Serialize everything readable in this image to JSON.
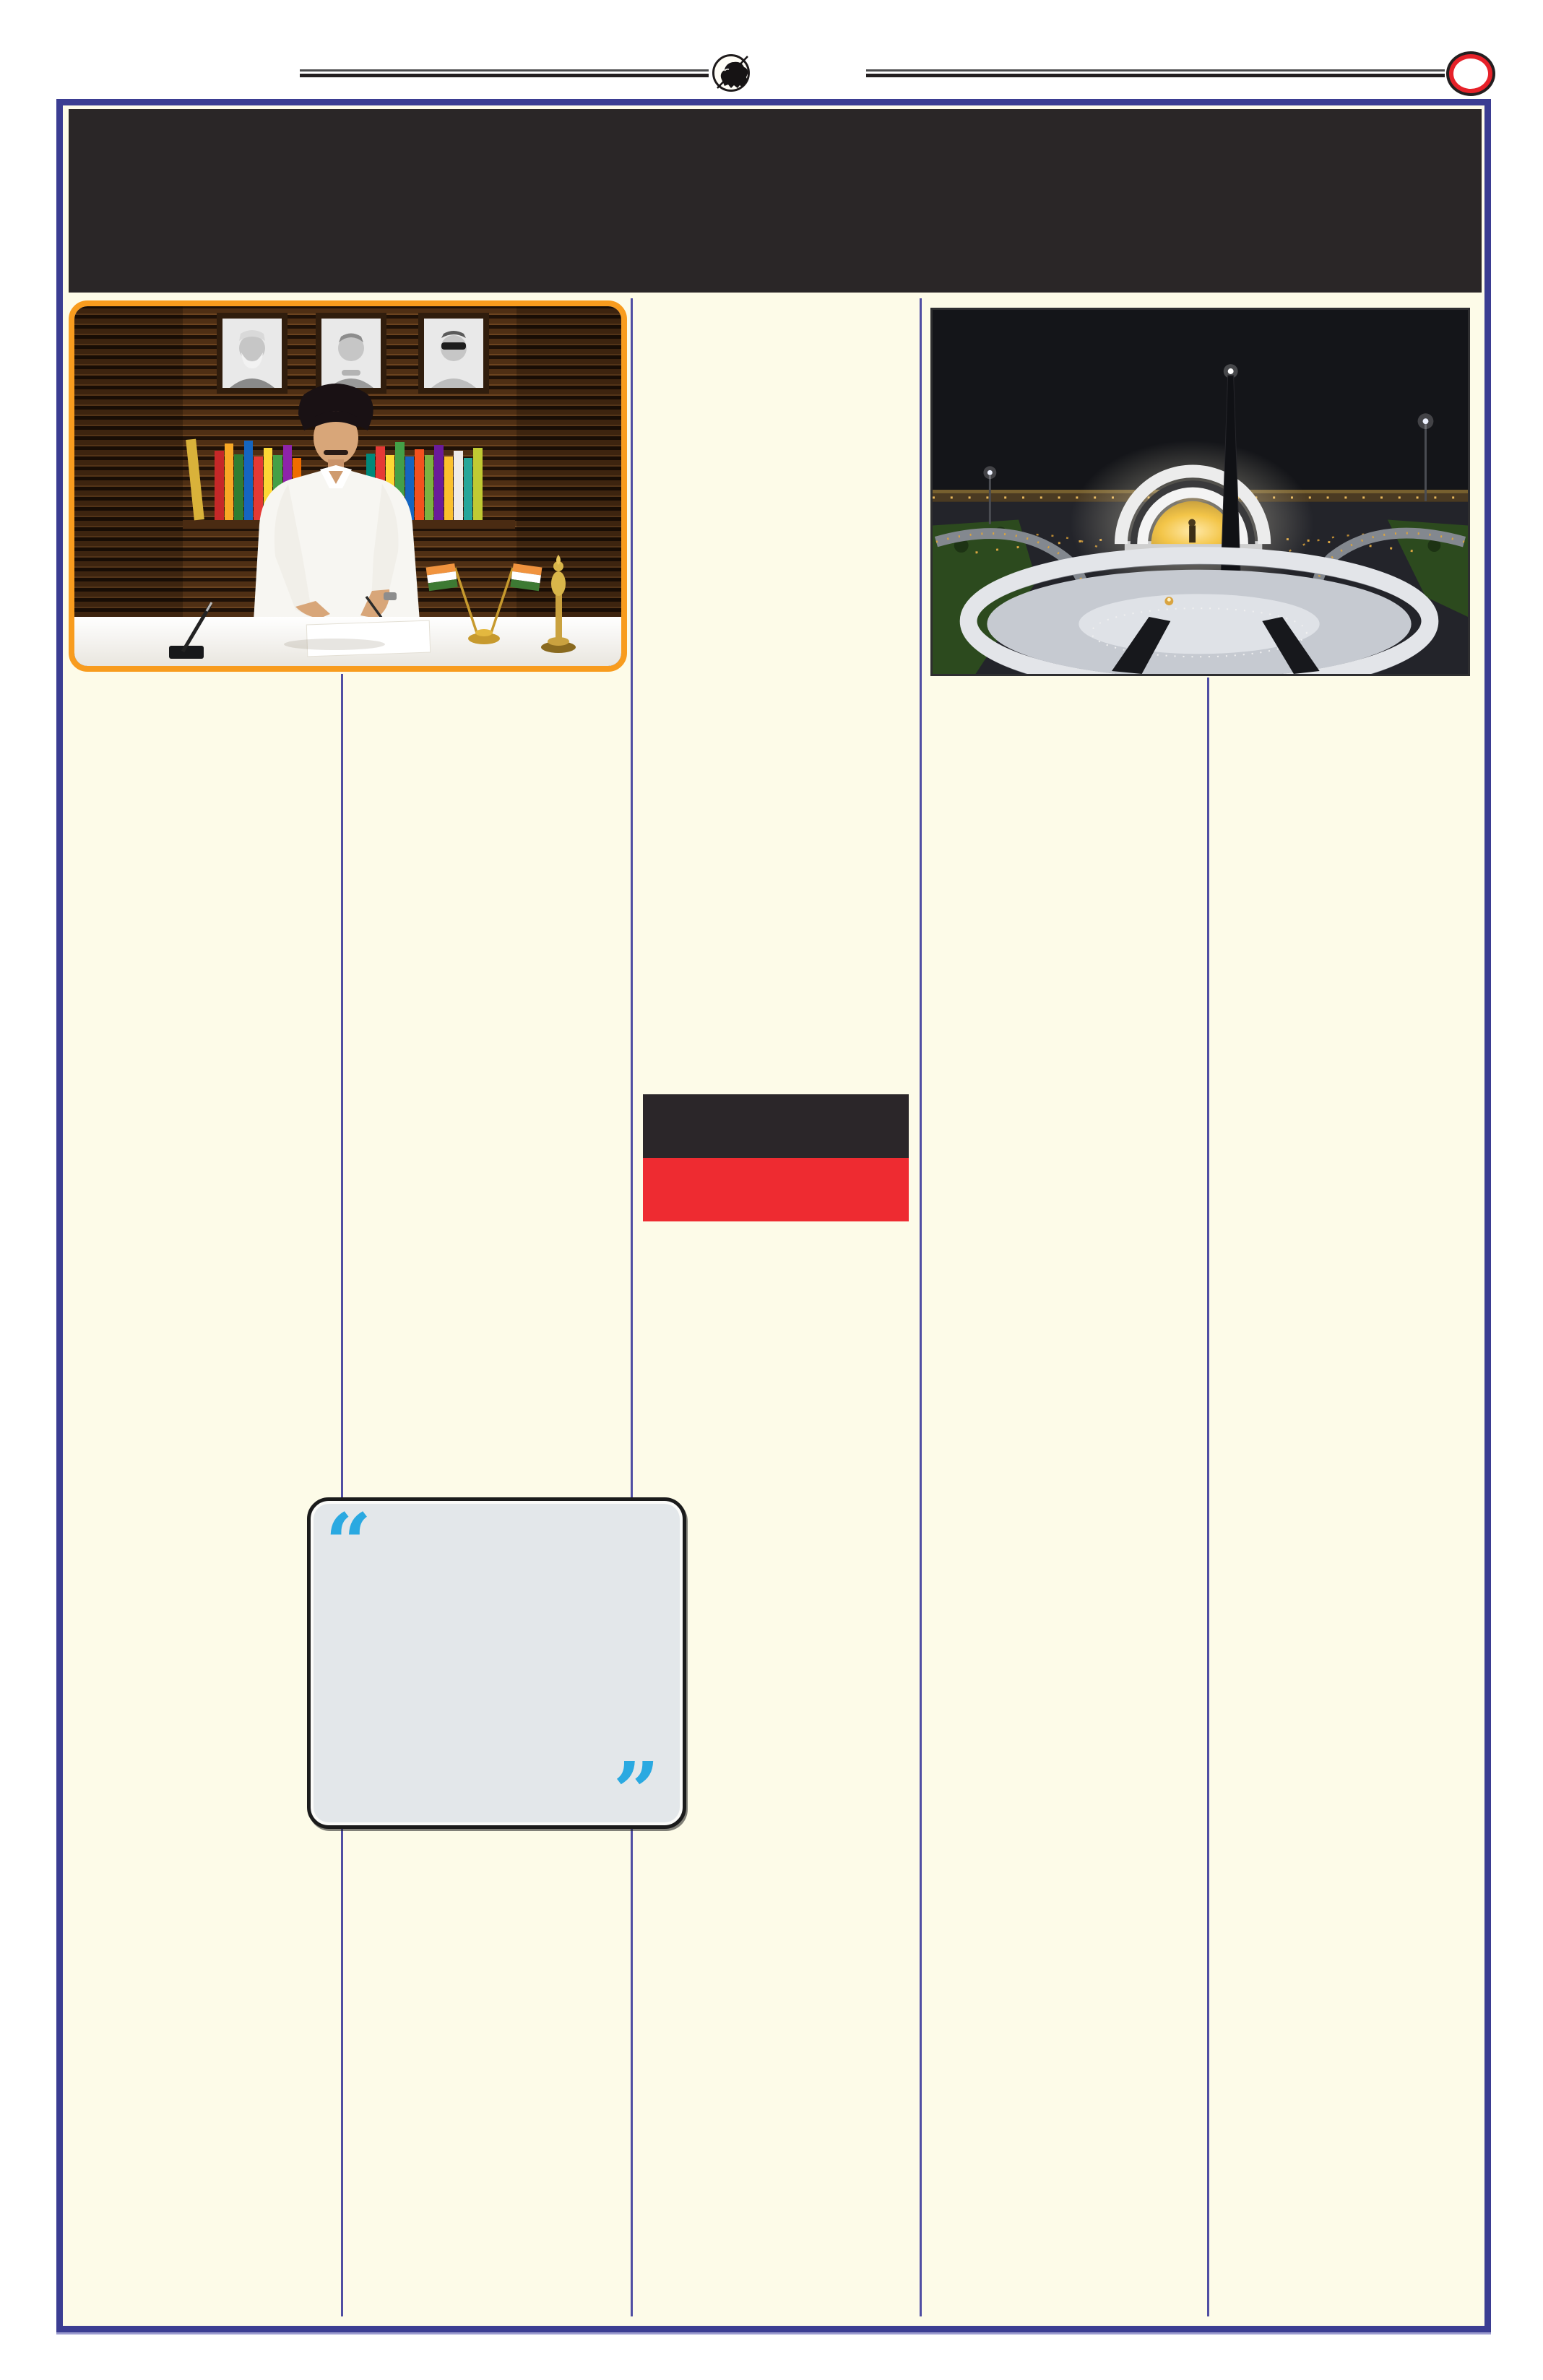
{
  "page": {
    "kind": "newspaper-page",
    "background_color": "#fdfbe8",
    "border_color": "#3b3d92",
    "masthead_band_color": "#2a2627",
    "columns": 5,
    "column_divider_color": "#504ea3"
  },
  "ornaments": {
    "left_rule_icon": "double-rule",
    "emblem_icon": "charging-bull-in-circle",
    "right_rule_icon": "double-rule",
    "badge_icon": "red-oval-ring",
    "rule_color": "#231f20",
    "badge_ring_color": "#e62129"
  },
  "photos": {
    "left": {
      "alt": "Leader in white shirt writing at a desk; wooden slat wall with three framed black-and-white portraits, bookshelf with colourful books, two Indian table flags and a golden award",
      "border_color": "#f89c1e"
    },
    "right": {
      "alt": "Night aerial view of an illuminated memorial: white arch with golden glow, dark obelisk with beacon, circular white plaza, lit walkways and lawns"
    }
  },
  "flag": {
    "name": "black-over-red party flag",
    "top_color": "#2b2629",
    "bottom_color": "#ee2b31"
  },
  "quote_box": {
    "open_quote": "“",
    "close_quote": "”",
    "quote_color": "#2aa9e1",
    "background": "#e3e7ea",
    "border_color": "#1b1b1b"
  }
}
